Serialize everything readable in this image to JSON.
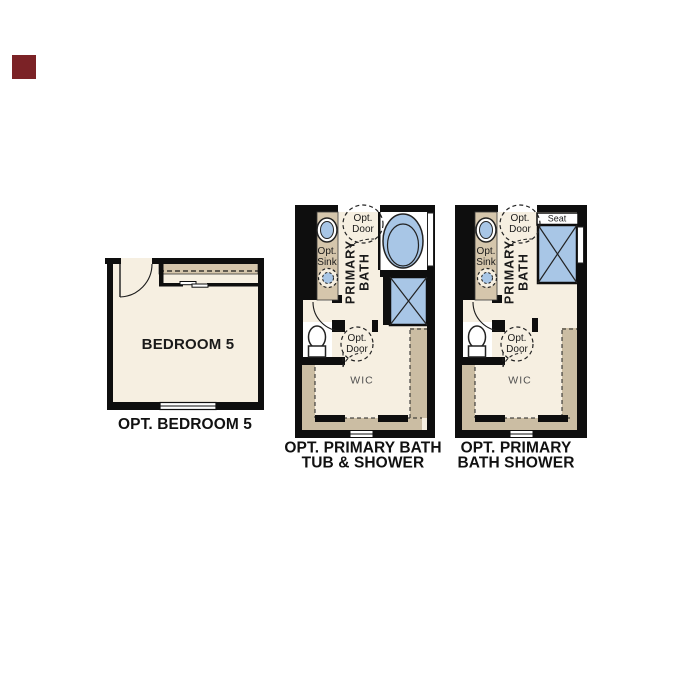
{
  "page": {
    "background": "#ffffff"
  },
  "logo": {
    "color": "#7b2226"
  },
  "colors": {
    "wall_black": "#0e0e0e",
    "floor_cream": "#f6efe1",
    "counter_tan": "#d5c6ac",
    "wic_wall_tan": "#cbbda3",
    "fixture_blue": "#a8c6e6"
  },
  "plans": {
    "bedroom": {
      "room_label": "BEDROOM 5",
      "caption": "OPT. BEDROOM 5"
    },
    "bath_tub_shower": {
      "labels": {
        "opt_sink_line1": "Opt.",
        "opt_sink_line2": "Sink",
        "primary_line1": "PRIMARY",
        "primary_line2": "BATH",
        "opt_door_top_line1": "Opt.",
        "opt_door_top_line2": "Door",
        "opt_door_wic_line1": "Opt.",
        "opt_door_wic_line2": "Door",
        "wic": "WIC"
      },
      "caption_line1": "OPT. PRIMARY BATH",
      "caption_line2": "TUB & SHOWER"
    },
    "bath_shower": {
      "labels": {
        "opt_sink_line1": "Opt.",
        "opt_sink_line2": "Sink",
        "primary_line1": "PRIMARY",
        "primary_line2": "BATH",
        "opt_door_top_line1": "Opt.",
        "opt_door_top_line2": "Door",
        "opt_door_wic_line1": "Opt.",
        "opt_door_wic_line2": "Door",
        "seat": "Seat",
        "wic": "WIC"
      },
      "caption_line1": "OPT. PRIMARY",
      "caption_line2": "BATH SHOWER"
    }
  }
}
